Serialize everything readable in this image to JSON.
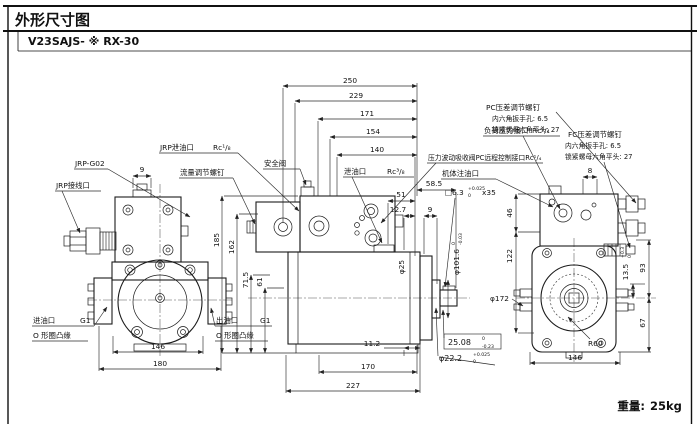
{
  "header": {
    "title": "外形尺寸图",
    "model": "V23SAJS- ※ RX-30"
  },
  "footer": {
    "weight_label": "重量:",
    "weight_value": "25kg"
  },
  "labels": {
    "jrp_model": "JRP-G02",
    "jrp_wiring": "JRP接线口",
    "jrp_drain": "JRP泄油口",
    "jrp_drain_size": "Rc¹/₈",
    "flow_screw": "流量调节螺钉",
    "safety_valve": "安全阀",
    "drain": "泄油口",
    "drain_size": "Rc³/₈",
    "inlet": "进油口",
    "inlet_size": "G1",
    "inlet_flange": "O 形圈凸缘",
    "outlet": "出油口",
    "outlet_size": "G1",
    "outlet_flange": "O 形圈凸缘",
    "load_port": "负荷压力接口",
    "load_port_size": "Rc¹/₄",
    "pc_remote": "压力波动吸收阀PC远程控制接口Rc¹/₄",
    "body_fill": "机体注油口",
    "key_spec": "□6.3",
    "key_tol_u": "+0.025",
    "key_tol_l": "0",
    "key_len": "x35",
    "pc_screw_title": "PC压差调节螺钉",
    "pc_screw_hex": "内六角扳手孔: 6.5",
    "pc_screw_nut": "锁紧螺母六角平头: 27",
    "fc_screw_title": "FC压差调节螺钉",
    "fc_screw_hex": "内六角扳手孔: 6.5",
    "fc_screw_nut": "锁紧螺母六角平头: 27"
  },
  "dims": {
    "d250": "250",
    "d229": "229",
    "d171": "171",
    "d154": "154",
    "d140": "140",
    "d58_5": "58.5",
    "d51": "51",
    "d12_7": "12.7",
    "d9_mid": "9",
    "d9_left": "9",
    "d8": "8",
    "d185": "185",
    "d162": "162",
    "d71_5": "71.5",
    "d61": "61",
    "phi25": "φ25",
    "phi101_6": "φ101.6",
    "phi101_6_u": "0",
    "phi101_6_l": "-0.03",
    "d11_2": "11.2",
    "d170": "170",
    "d227": "227",
    "d146_left": "146",
    "d180": "180",
    "d146_right": "146",
    "d25_08": "25.08",
    "d25_08_u": "0",
    "d25_08_l": "-0.23",
    "phi22_2": "φ22.2",
    "phi22_2_u": "+0.025",
    "phi22_2_l": "0",
    "d46": "46",
    "d122": "122",
    "phi172": "φ172",
    "r60": "R60",
    "d13_5": "13.5",
    "d13_5_u": "+0.3",
    "d13_5_l": "0",
    "d93": "93",
    "d67": "67"
  }
}
